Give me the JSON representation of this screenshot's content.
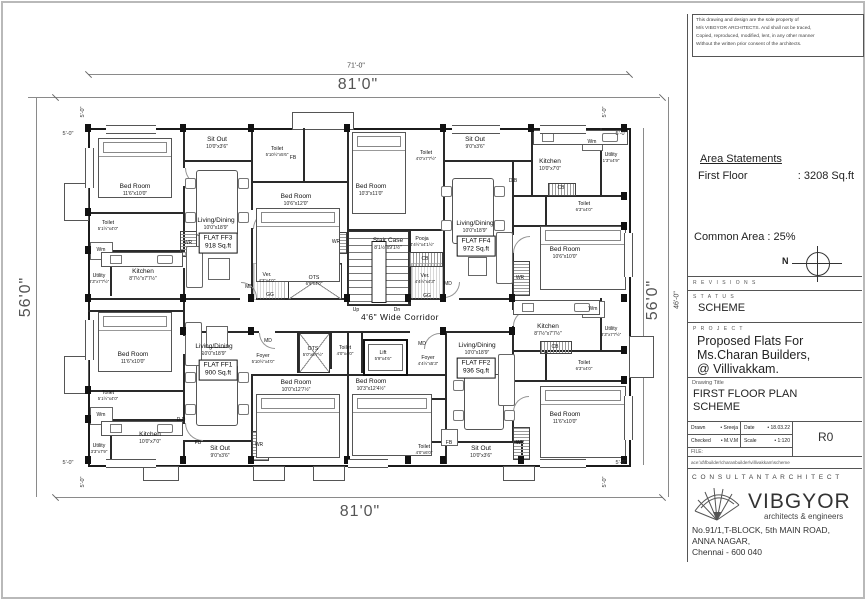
{
  "dims": {
    "top_inner": "71'-0\"",
    "top": "81'0\"",
    "bottom": "81'0\"",
    "left": "56'0\"",
    "right": "56'0\"",
    "right_inner": "46'-0\"",
    "offset": "5'-0\""
  },
  "plan": {
    "corridor": "4'6\" Wide Corridor",
    "core": {
      "stair": {
        "n": "Stair Case",
        "d": "8'1½\"x9'1½\""
      },
      "up": "Up",
      "dn": "Dn",
      "ots_top": {
        "n": "OTS",
        "d": "6'9\"x4'0\""
      },
      "ots_bottom": {
        "n": "OTS",
        "d": "5'0\"x6'7½\""
      },
      "ver_left": {
        "n": "Ver.",
        "d": "4'3\"x4'0\""
      },
      "ver_right": {
        "n": "Ver.",
        "d": "4'4½\"x4'3\""
      },
      "pooja": {
        "n": "Pooja",
        "d": "4'4½\"x4'1½\""
      },
      "toilet": {
        "n": "Toilet",
        "d": "4'0\"x4'0\""
      },
      "lift": {
        "n": "Lift",
        "d": "5'9\"x4'6\""
      },
      "foyer_ff1": {
        "n": "Foyer",
        "d": "5'10½\"x4'0\""
      },
      "foyer_ff2": {
        "n": "Foyer",
        "d": "4'4½\"x5'3\""
      }
    },
    "ff3": {
      "flat": "FLAT FF3",
      "area": "918 Sq.ft",
      "bed1": {
        "n": "Bed Room",
        "d": "11'6\"x10'0\""
      },
      "bed2": {
        "n": "Bed Room",
        "d": "10'6\"x12'0\""
      },
      "living": {
        "n": "Living/Dining",
        "d": "10'0\"x18'9\""
      },
      "sitout": {
        "n": "Sit Out",
        "d": "10'0\"x3'6\""
      },
      "toilet1": {
        "n": "Toilet",
        "d": "5'1½\"x4'0\""
      },
      "toilet2": {
        "n": "Toilet",
        "d": "5'10½\"x5'6\""
      },
      "kitchen": {
        "n": "Kitchen",
        "d": "8'7½\"x7'7½\""
      },
      "utility": {
        "n": "Utility",
        "d": "3'3\"x7'7½\""
      }
    },
    "ff4": {
      "flat": "FLAT FF4",
      "area": "972 Sq.ft",
      "bed1": {
        "n": "Bed Room",
        "d": "10'3\"x11'0\""
      },
      "bed2": {
        "n": "Bed Room",
        "d": "10'6\"x10'0\""
      },
      "living": {
        "n": "Living/Dining",
        "d": "10'0\"x18'9\""
      },
      "sitout": {
        "n": "Sit Out",
        "d": "9'0\"x3'6\""
      },
      "toilet1": {
        "n": "Toilet",
        "d": "4'0\"x7'7½\""
      },
      "toilet2": {
        "n": "Toilet",
        "d": "6'3\"x4'0\""
      },
      "kitchen": {
        "n": "Kitchen",
        "d": "10'0\"x7'0\""
      },
      "utility": {
        "n": "Utility",
        "d": "1'3\"x4'9\""
      }
    },
    "ff1": {
      "flat": "FLAT FF1",
      "area": "900 Sq.ft",
      "bed1": {
        "n": "Bed Room",
        "d": "11'6\"x10'0\""
      },
      "bed2": {
        "n": "Bed Room",
        "d": "10'0\"x12'7½\""
      },
      "living": {
        "n": "Living/Dining",
        "d": "10'0\"x18'9\""
      },
      "sitout": {
        "n": "Sit Out",
        "d": "9'0\"x3'6\""
      },
      "toilet1": {
        "n": "Toilet",
        "d": "5'1½\"x4'0\""
      },
      "kitchen": {
        "n": "Kitchen",
        "d": "10'0\"x7'0\""
      },
      "utility": {
        "n": "Utility",
        "d": "3'3\"x7'9\""
      }
    },
    "ff2": {
      "flat": "FLAT FF2",
      "area": "936 Sq.ft",
      "bed1": {
        "n": "Bed Room",
        "d": "10'3\"x12'4½\""
      },
      "bed2": {
        "n": "Bed Room",
        "d": "11'6\"x10'0\""
      },
      "living": {
        "n": "Living/Dining",
        "d": "10'0\"x18'9\""
      },
      "sitout": {
        "n": "Sit Out",
        "d": "10'0\"x3'6\""
      },
      "toilet1": {
        "n": "Toilet",
        "d": "4'0\"x6'0\""
      },
      "toilet2": {
        "n": "Toilet",
        "d": "6'3\"x4'0\""
      },
      "kitchen": {
        "n": "Kitchen",
        "d": "8'7½\"x7'7½\""
      },
      "utility": {
        "n": "Utility",
        "d": "3'3\"x7'7½\""
      }
    },
    "tags": {
      "wr": "WR",
      "cb": "CB",
      "md": "MD",
      "gg": "GG",
      "db": "D.B",
      "dd": "D.D",
      "wm": "Wm",
      "fb": "FB"
    }
  },
  "tb": {
    "disclaimer_l1": "This drawing and design are the sole property of",
    "disclaimer_l2": "M/s VIBGYOR ARCHITECTS.  And shall not be traced,",
    "disclaimer_l3": "Copied, reproduced, modified, lent, in any other manner",
    "disclaimer_l4": "Without the written prior consent of the architects.",
    "area_heading": "Area Statements",
    "first_floor_label": "First Floor",
    "first_floor_value": ": 3208 Sq.ft",
    "common_area": "Common Area : 25%",
    "north": "N",
    "revisions": "R E V I S I O N S",
    "status_label": "S T A T U S",
    "status_value": "SCHEME",
    "project_label": "P R O J E C T",
    "project_l1": "Proposed Flats For",
    "project_l2": "Ms.Charan Builders,",
    "project_l3": "@ Villivakkam.",
    "drawing_title_label": "Drawing Title",
    "title_l1": "FIRST FLOOR PLAN",
    "title_l2": "SCHEME",
    "drawn_label": "Drawn",
    "drawn_value": "•  Sreeja",
    "date_label": "Date",
    "date_value": "•  18.03.22",
    "checked_label": "Checked",
    "checked_value": "•  M.V.M",
    "scale_label": "Scale",
    "scale_value": "•  1:120",
    "revision": "R0",
    "file_label": "FILE:",
    "file_path": "ace:\\d\\fbuilder\\charanbuilder\\villivakkam\\scheme",
    "consultant": "C O N S U L T A N T   A R C H I T E C T",
    "firm": "VIBGYOR",
    "tagline": "architects & engineers",
    "addr1": "No.91/1,T-BLOCK, 5th MAIN ROAD,",
    "addr2": "ANNA NAGAR,",
    "addr3": "Chennai - 600 040"
  }
}
